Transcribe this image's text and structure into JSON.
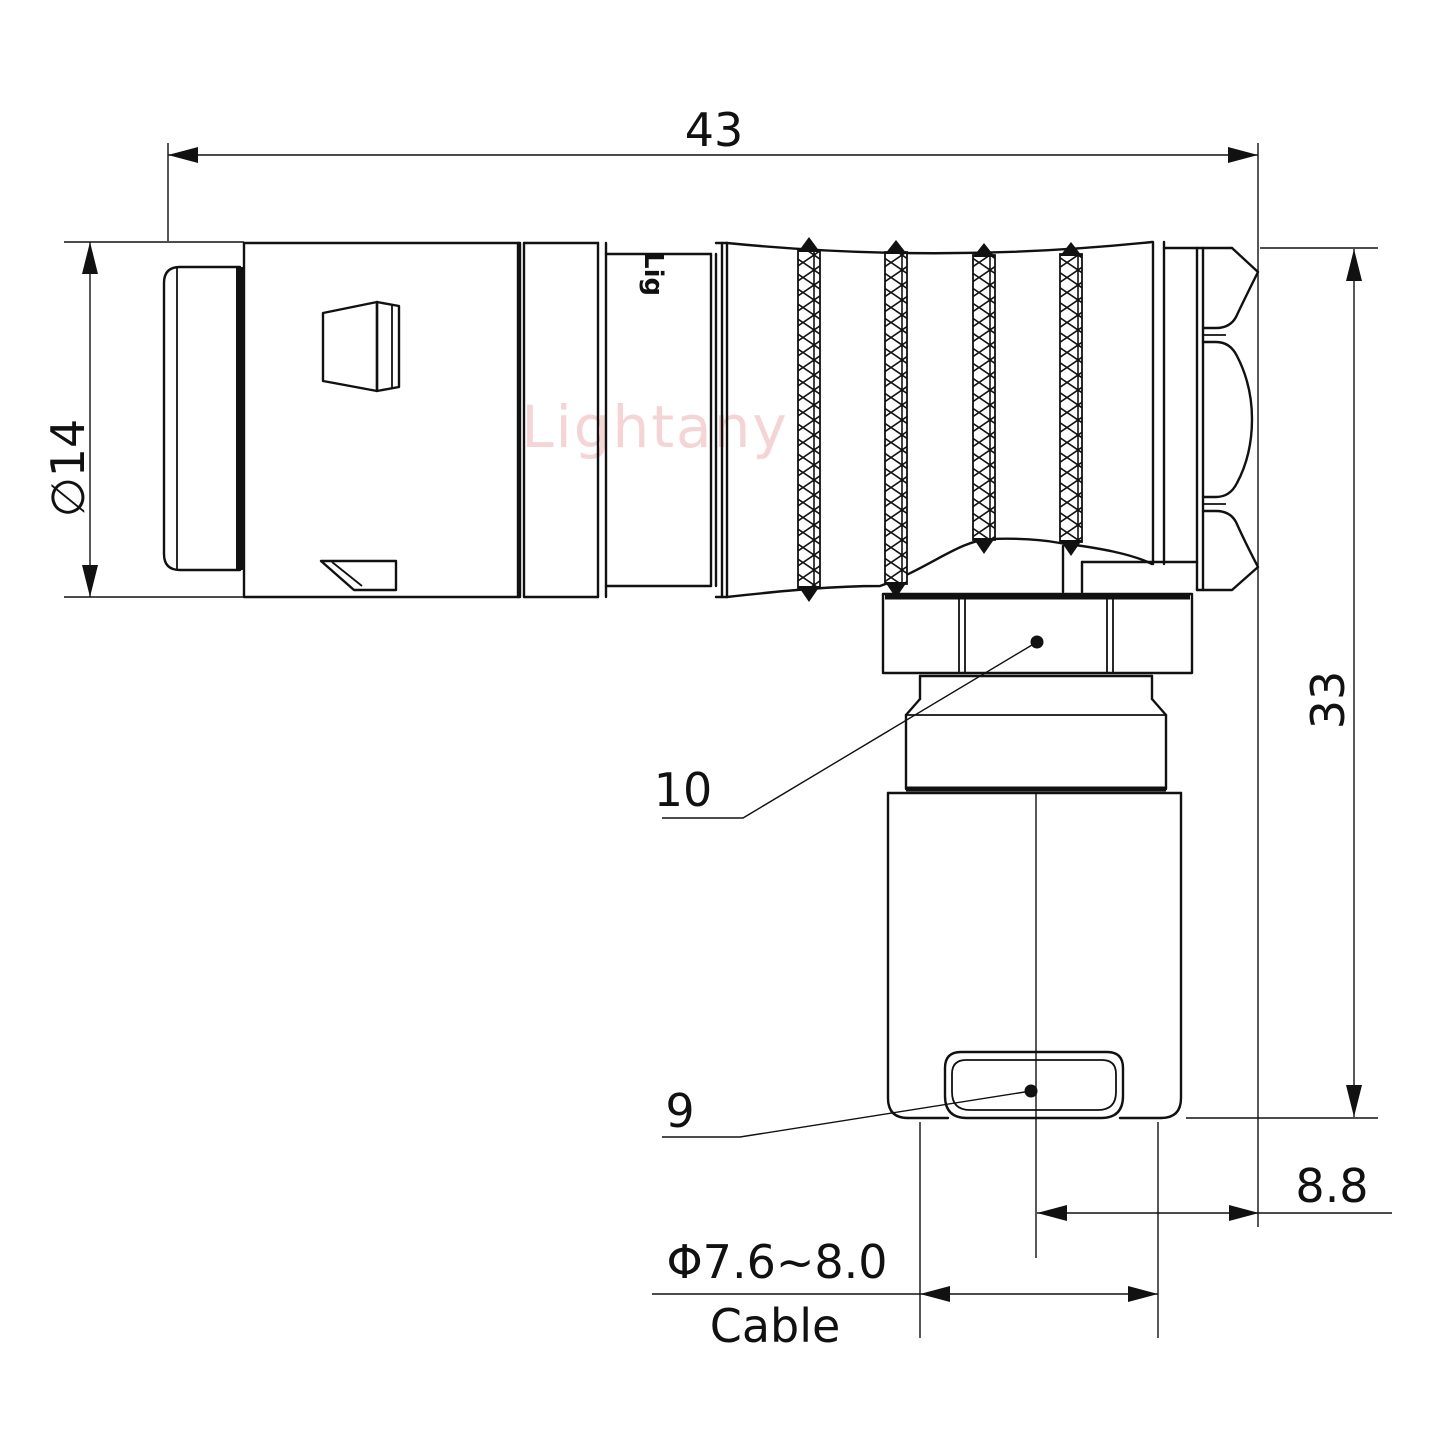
{
  "drawing": {
    "watermark": "Lightany",
    "body_marking": "Lig",
    "colors": {
      "line": "#111111",
      "watermark": "#eaabab",
      "background": "#ffffff"
    },
    "dimensions": {
      "overall_length": "43",
      "front_diameter": "∅14",
      "height": "33",
      "rear_offset": "8.8",
      "cable_diameter": "Φ7.6~8.0",
      "cable_word": "Cable"
    },
    "part_labels": {
      "coupling_nut": "10",
      "cable_clamp": "9"
    }
  }
}
